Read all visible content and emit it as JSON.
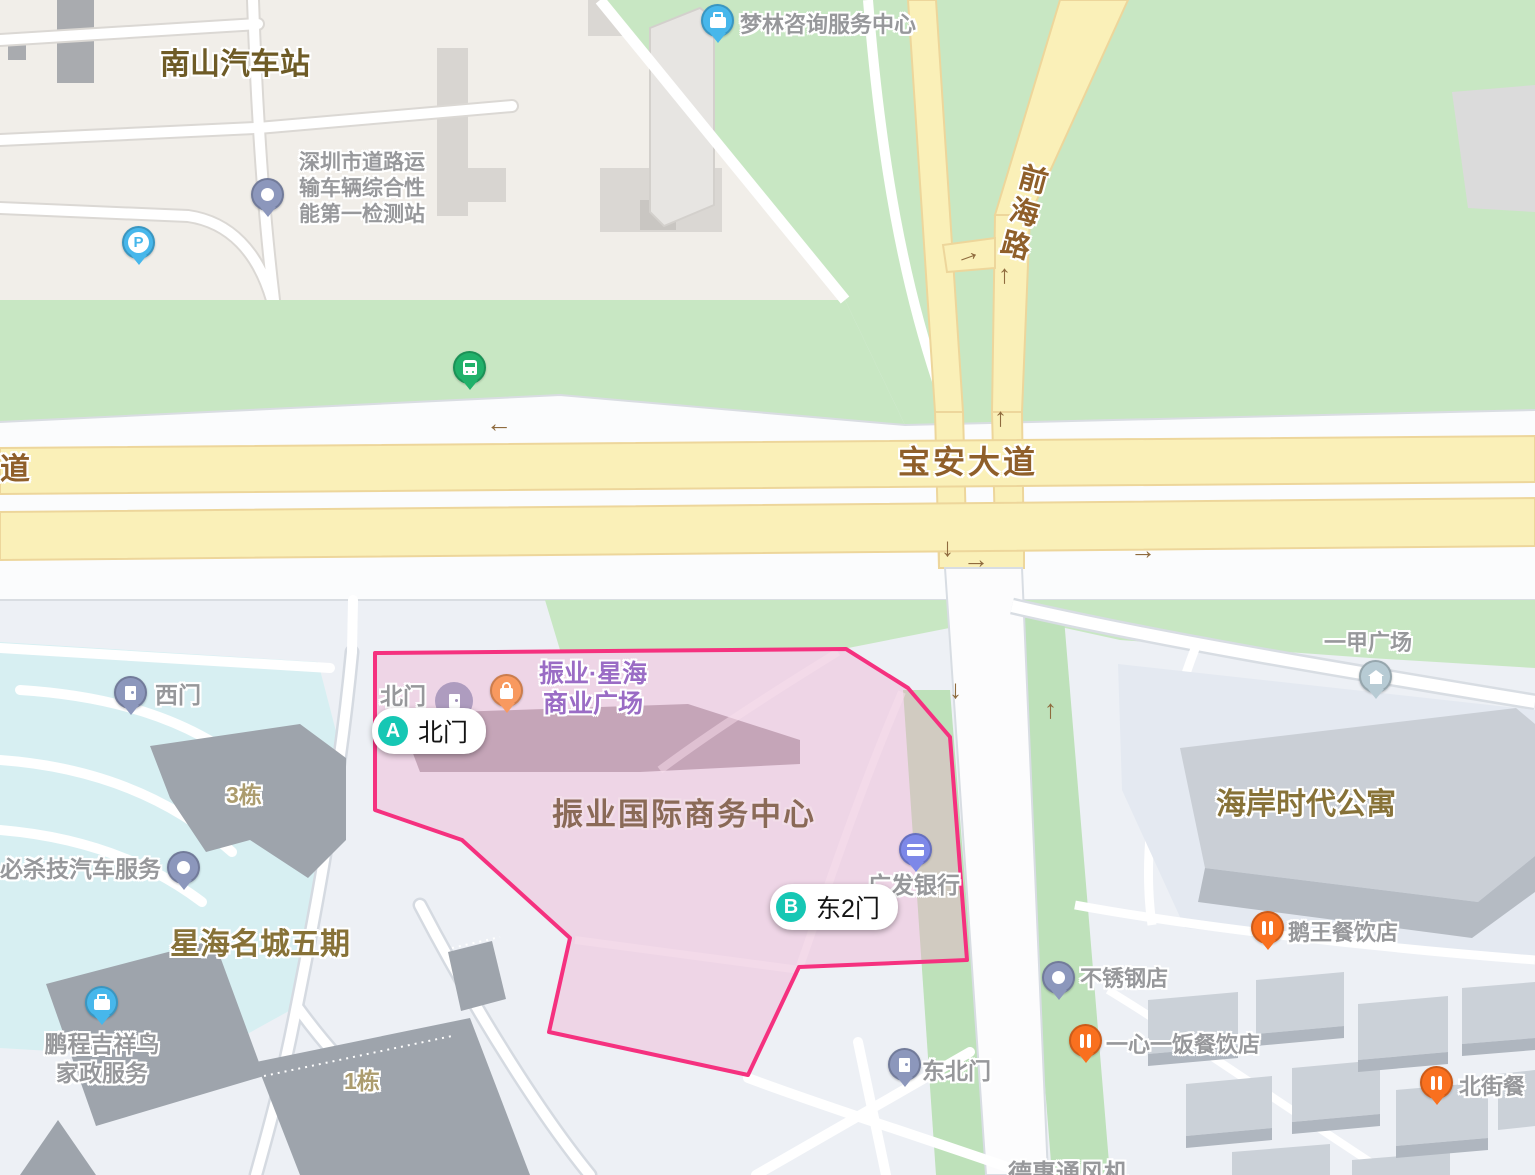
{
  "colors": {
    "accent_pink": "#F5317F",
    "road_yellow": "#FAF0B8",
    "park_green": "#C8E7C3",
    "teal_marker": "#16C7B4",
    "water_blue": "#D7EFF2"
  },
  "roads": {
    "baoan_avenue": "宝安大道",
    "qianhai_road": "前海路",
    "partial_road": "道"
  },
  "gates": {
    "a": {
      "letter": "A",
      "label": "北门"
    },
    "b": {
      "letter": "B",
      "label": "东2门"
    }
  },
  "poi": {
    "nanshan_station": "南山汽车站",
    "inspection_lines": [
      "深圳市道路运",
      "输车辆综合性",
      "能第一检测站"
    ],
    "menglin": "梦林咨询服务中心",
    "north_gate_small": "北门",
    "zhenye_xinghai_lines": [
      "振业·星海",
      "商业广场"
    ],
    "zhenye_center": "振业国际商务中心",
    "guangfa_bank": "广发银行",
    "west_gate": "西门",
    "building_3": "3栋",
    "bisha_auto": "必杀技汽车服务",
    "xinghai_mingcheng": "星海名城五期",
    "pengcheng_lines": [
      "鹏程吉祥鸟",
      "家政服务"
    ],
    "building_1": "1栋",
    "haian_apartments": "海岸时代公寓",
    "yijia_plaza": "一甲广场",
    "ewang_restaurant": "鹅王餐饮店",
    "stainless_shop": "不锈钢店",
    "yixin_restaurant": "一心一饭餐饮店",
    "beijie_restaurant": "北街餐",
    "northeast_gate": "东北门",
    "dehui_partial": "德惠通风机"
  },
  "icons": {
    "parking_letter": "P",
    "arrow_left": "←",
    "arrow_right": "→",
    "arrow_up": "↑",
    "arrow_down": "↓"
  }
}
